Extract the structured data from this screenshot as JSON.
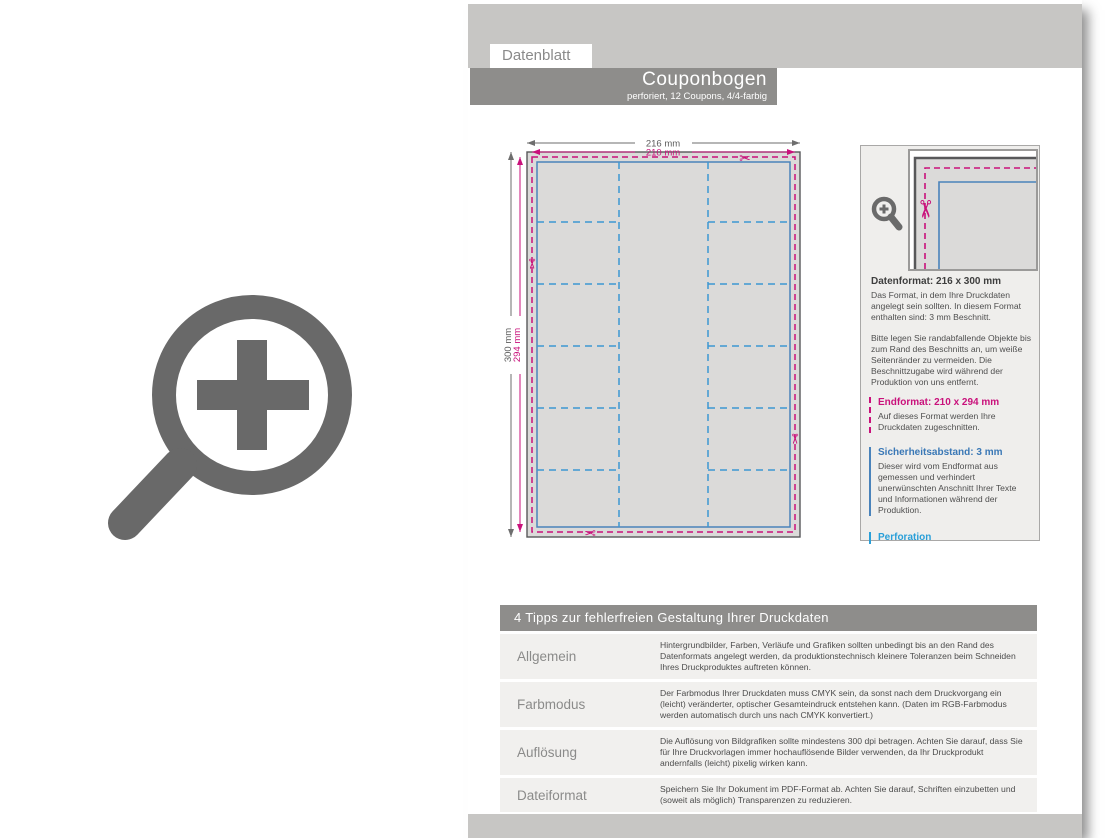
{
  "header": {
    "tab": "Datenblatt",
    "title": "Couponbogen",
    "subtitle": "perforiert, 12 Coupons, 4/4-farbig"
  },
  "diagram": {
    "outer_width": "216 mm",
    "trim_width": "210 mm",
    "outer_height": "300 mm",
    "trim_height": "294 mm",
    "grid": {
      "columns": 3,
      "side_column_rows": 6,
      "coupons": 12
    }
  },
  "icons": {
    "scissors": "✂"
  },
  "colors": {
    "band_gray": "#c7c6c4",
    "banner_gray": "#8e8d8b",
    "magenta": "#c9117b",
    "safety_blue": "#4a83bb",
    "perforation_blue": "#3d97d3",
    "cyan_heading": "#2a9fd8",
    "sheet_fill": "#dbdad9",
    "icon_gray": "#696969"
  },
  "info_panel": {
    "datenformat": {
      "title": "Datenformat: 216 x 300 mm",
      "p1": "Das Format, in dem Ihre Druckdaten angelegt sein sollten. In diesem Format enthalten sind: 3 mm Beschnitt.",
      "p2": "Bitte legen Sie randabfallende Objekte bis zum Rand des Beschnitts an, um weiße Seitenränder zu vermeiden. Die Beschnittzugabe wird während der Produktion von uns entfernt."
    },
    "endformat": {
      "title": "Endformat: 210 x 294 mm",
      "p": "Auf dieses Format werden Ihre Druckdaten zugeschnitten."
    },
    "sicherheitsabstand": {
      "title": "Sicherheitsabstand: 3 mm",
      "p": "Dieser wird vom Endformat aus gemessen und verhindert unerwünschten Anschnitt Ihrer Texte und Informationen während der Produktion."
    },
    "perforation": {
      "title": "Perforation"
    }
  },
  "tips": {
    "title": "4 Tipps zur fehlerfreien Gestaltung Ihrer Druckdaten",
    "rows": [
      {
        "label": "Allgemein",
        "text": "Hintergrundbilder, Farben, Verläufe und Grafiken sollten unbedingt bis an den Rand des Datenformats angelegt werden, da produktionstechnisch kleinere Toleranzen beim Schneiden Ihres Druckproduktes auftreten können."
      },
      {
        "label": "Farbmodus",
        "text": "Der Farbmodus Ihrer Druckdaten muss CMYK sein, da sonst nach dem Druckvorgang ein (leicht) veränderter, optischer Gesamteindruck entstehen kann. (Daten im RGB-Farbmodus werden automatisch durch uns nach CMYK konvertiert.)"
      },
      {
        "label": "Auflösung",
        "text": "Die Auflösung von Bildgrafiken sollte mindestens 300 dpi betragen. Achten Sie darauf, dass Sie für Ihre Druckvorlagen immer hochauflösende Bilder verwenden, da Ihr Druckprodukt andernfalls (leicht) pixelig wirken kann."
      },
      {
        "label": "Dateiformat",
        "text": "Speichern Sie Ihr Dokument im PDF-Format ab. Achten Sie darauf, Schriften einzubetten und (soweit als möglich) Transparenzen zu reduzieren."
      }
    ]
  }
}
